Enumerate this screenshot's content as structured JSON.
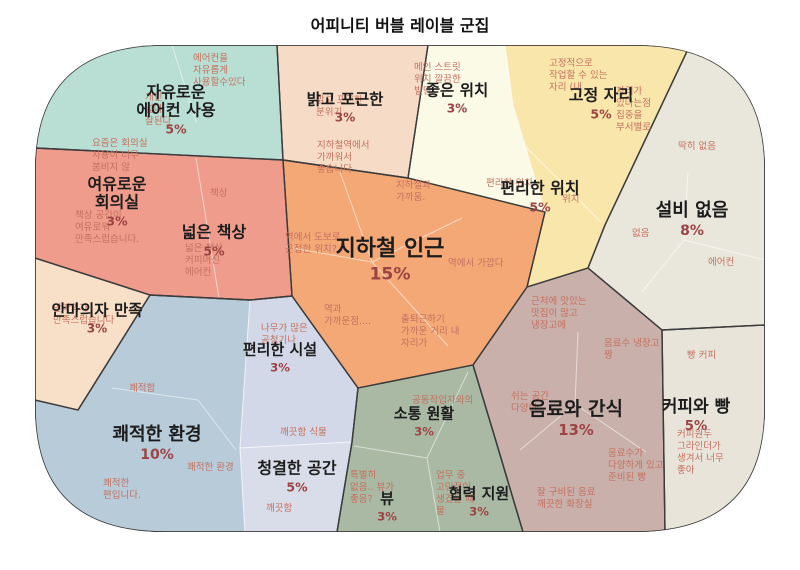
{
  "title": "어피니티 버블 레이블 군집",
  "colors": {
    "label_text": "#1c1c1c",
    "percent_text": "#9c4444",
    "note_text": "#c4705f",
    "cluster_outline": "#3b3b3b",
    "inner_divider": "rgba(255,255,255,0.55)"
  },
  "chart_data": {
    "type": "voronoi-treemap",
    "title": "어피니티 버블 레이블 군집",
    "categories": [
      "자유로운 에어컨 사용",
      "밝고 포근한",
      "좋은 위치",
      "고정 자리",
      "편리한 위치",
      "설비 없음",
      "여유로운 회의실",
      "넓은 책상",
      "지하철 인근",
      "안마의자 만족",
      "편리한 시설",
      "쾌적한 환경",
      "청결한 공간",
      "소통 원활",
      "뷰",
      "협력 지원",
      "음료와 간식",
      "커피와 빵"
    ],
    "values": [
      5,
      3,
      3,
      5,
      5,
      8,
      3,
      5,
      15,
      3,
      3,
      10,
      5,
      3,
      3,
      3,
      13,
      5
    ],
    "unit": "%",
    "legend": "none",
    "grid": "off"
  },
  "regions": [
    {
      "id": "free-aircon",
      "label": "자유로운\n에어컨 사용",
      "pct": "5%",
      "color": "#b9ded4",
      "notes": [
        {
          "text": "에어컨을\n자유롭게\n사용할수있다"
        },
        {
          "text": "개인\n넓다\n잘된다"
        }
      ]
    },
    {
      "id": "bright-cozy",
      "label": "밝고 포근한",
      "pct": "3%",
      "color": "#f6dcc6",
      "notes": [
        {
          "text": "밝고 포근한\n분위기"
        }
      ]
    },
    {
      "id": "good-location",
      "label": "좋은 위치",
      "pct": "3%",
      "color": "#fafae7",
      "notes": [
        {
          "text": "메인 스트릿\n위치 깔끔한\n빌딩"
        }
      ]
    },
    {
      "id": "fixed-seat",
      "label": "고정 자리",
      "pct": "5%",
      "color": "#f9e6ab",
      "notes": [
        {
          "text": "고정적으로\n작업할 수 있는\n자리 (내"
        },
        {
          "text": "자리가\n있다는점\n집중을\n부서별로"
        }
      ]
    },
    {
      "id": "convenient-location",
      "label": "편리한 위치",
      "pct": "5%",
      "color": "#f9e6ab",
      "notes": [
        {
          "text": "편리한 위치"
        },
        {
          "text": "위치"
        }
      ]
    },
    {
      "id": "no-facility",
      "label": "설비 없음",
      "pct": "8%",
      "color": "#e9e7dc",
      "notes": [
        {
          "text": "딱히 없음"
        },
        {
          "text": "없음"
        },
        {
          "text": "에어컨"
        }
      ]
    },
    {
      "id": "relaxed-meeting-room",
      "label": "여유로운\n회의실",
      "pct": "3%",
      "color": "#ef9c8c",
      "notes": [
        {
          "text": "요즘은 회의실\n사용이 너무\n붐비지 않"
        },
        {
          "text": "책상 공간이\n여유로워\n만족스럽습니다."
        }
      ]
    },
    {
      "id": "wide-desk",
      "label": "넓은 책상",
      "pct": "5%",
      "color": "#ef9c8c",
      "notes": [
        {
          "text": "책상"
        },
        {
          "text": "넓은 책상\n커피머신\n에어컨"
        }
      ]
    },
    {
      "id": "near-subway",
      "label": "지하철 인근",
      "pct": "15%",
      "color": "#f4a876",
      "notes": [
        {
          "text": "지하철역에서\n가까워서\n좋습니다."
        },
        {
          "text": "지하철과\n가까움."
        },
        {
          "text": "역에서 도보로\n근접한 위치?"
        },
        {
          "text": "역에서 가깝다"
        },
        {
          "text": "역과\n가까운점...."
        },
        {
          "text": "출퇴근하기\n가까운 거리 내\n자리가"
        }
      ]
    },
    {
      "id": "massage-chair",
      "label": "안마의자 만족",
      "pct": "3%",
      "color": "#f8dfc7",
      "notes": [
        {
          "text": "안마의자\n만족스럽습니다"
        }
      ]
    },
    {
      "id": "convenient-facility",
      "label": "편리한 시설",
      "pct": "3%",
      "color": "#d2d8e8",
      "notes": [
        {
          "text": "나무가 많은\n공청기나"
        }
      ]
    },
    {
      "id": "pleasant-environment",
      "label": "쾌적한 환경",
      "pct": "10%",
      "color": "#b7cbd9",
      "notes": [
        {
          "text": "쾌적함"
        },
        {
          "text": "쾌적한 환경"
        },
        {
          "text": "쾌적한\n편입니다."
        }
      ]
    },
    {
      "id": "clean-space",
      "label": "청결한 공간",
      "pct": "5%",
      "color": "#d9ddea",
      "notes": [
        {
          "text": "깨끗함 식물"
        },
        {
          "text": "깨끗함"
        }
      ]
    },
    {
      "id": "smooth-communication",
      "label": "소통 원활",
      "pct": "3%",
      "color": "#a9b9a3",
      "notes": [
        {
          "text": "공동작업자와의"
        }
      ]
    },
    {
      "id": "view",
      "label": "뷰",
      "pct": "3%",
      "color": "#a9b9a3",
      "notes": [
        {
          "text": "특별히\n없음.. 뷰가\n좋음?"
        }
      ]
    },
    {
      "id": "cooperation-support",
      "label": "협력 지원",
      "pct": "3%",
      "color": "#a9b9a3",
      "notes": [
        {
          "text": "업무 중\n고민점이\n생겼을 때\n물"
        }
      ]
    },
    {
      "id": "drinks-snacks",
      "label": "음료와 간식",
      "pct": "13%",
      "color": "#c9b0ab",
      "notes": [
        {
          "text": "근처에 맛있는\n맛집이 많고\n냉장고에"
        },
        {
          "text": "음료수 냉장고\n짱"
        },
        {
          "text": "쉬는 공간\n다양한"
        },
        {
          "text": "음료수가\n다양하게 있고\n준비된 빵"
        },
        {
          "text": "잘 구비된 음료\n깨끗한 화장실"
        }
      ]
    },
    {
      "id": "coffee-bread",
      "label": "커피와 빵",
      "pct": "5%",
      "color": "#e8e4da",
      "notes": [
        {
          "text": "빵 커피"
        },
        {
          "text": "커피원두\n그라인더가\n생겨서 너무\n좋아"
        }
      ]
    }
  ]
}
